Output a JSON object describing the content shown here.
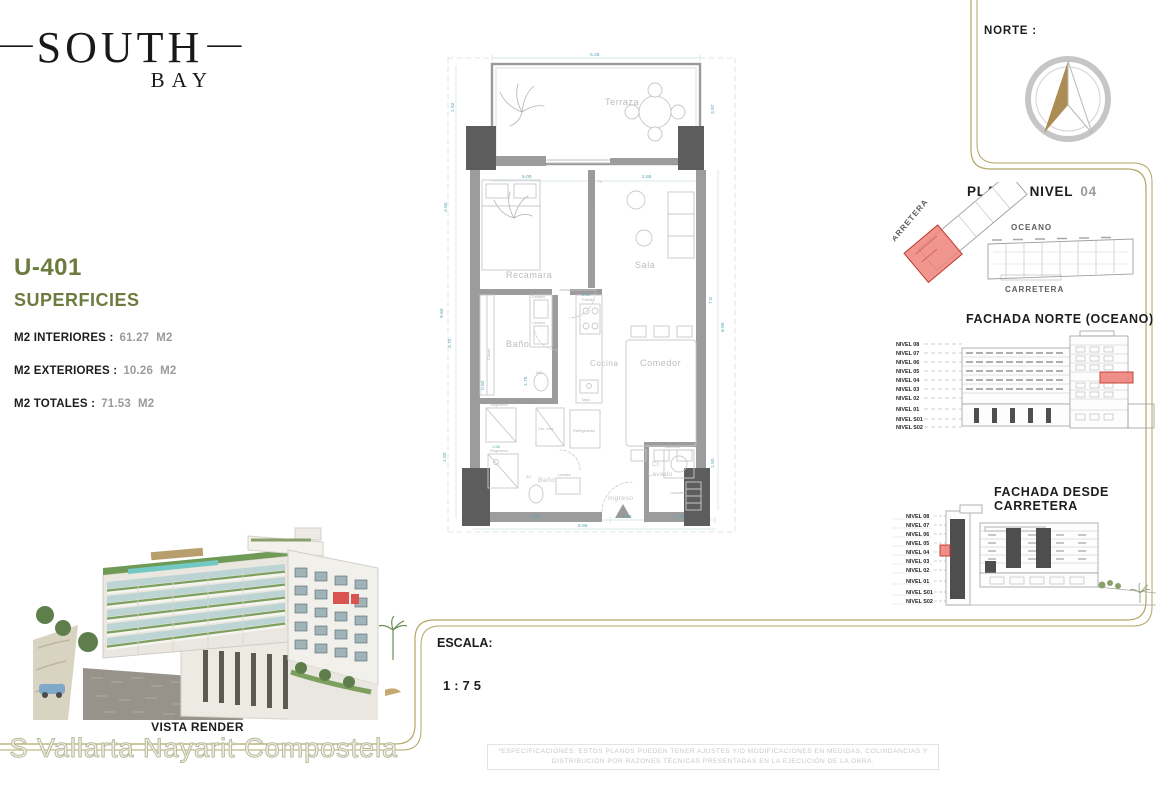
{
  "logo": {
    "dash": "—",
    "title": "SOUTH",
    "subtitle": "BAY"
  },
  "unit": {
    "id": "U-401",
    "section_title": "SUPERFICIES",
    "rows": [
      {
        "label": "M2 INTERIORES :",
        "value": "61.27",
        "m2": "M2"
      },
      {
        "label": "M2 EXTERIORES :",
        "value": "10.26",
        "m2": "M2"
      },
      {
        "label": "M2 TOTALES :",
        "value": "71.53",
        "m2": "M2"
      }
    ]
  },
  "norte": {
    "label": "NORTE :"
  },
  "planta": {
    "title": "PLANTA NIVEL",
    "number": "04",
    "top_label": "OCEANO",
    "bottom_label": "CARRETERA",
    "side_label": "CARRETERA"
  },
  "levels": [
    "NIVEL 08",
    "NIVEL 07",
    "NIVEL 06",
    "NIVEL 05",
    "NIVEL 04",
    "NIVEL 03",
    "NIVEL 02",
    "NIVEL 01",
    "NIVEL S01",
    "NIVEL S02"
  ],
  "fachada_norte": {
    "title": "FACHADA NORTE (OCEANO)"
  },
  "fachada_carretera": {
    "title": "FACHADA DESDE CARRETERA"
  },
  "floorplan": {
    "rooms": {
      "terraza": "Terraza",
      "recamara": "Recamara",
      "sala": "Sala",
      "bano": "Baño",
      "cocina": "Cocina",
      "comedor": "Comedor",
      "closet": "Closet",
      "cl_lavado_1": "Cl.",
      "cl_lavado_2": "Lavado",
      "ingreso": "Ingreso"
    },
    "fixtures": {
      "lavabo": "Lavabo",
      "wc": "WC",
      "parrilla": "Parrilla",
      "tarja": "Tarja",
      "refrigerador": "Refrigerador",
      "regadera": "Regadera",
      "lavadero": "Lavadero",
      "lav_sec": "Lav./Sec.",
      "cto_inst": "Cto. Inst.",
      "tv": "TV",
      "ac": "AC"
    },
    "dims": {
      "top": "5.28",
      "recamara_w": "5.00",
      "sala_w": "2.65",
      "l1": "1.52",
      "l2": "4.50",
      "l3": "9.60",
      "l4": "3.70",
      "l5": "1.50",
      "l6": "0.60",
      "d175": "1.75",
      "d158": "1.58",
      "parrilla_w": "0.90",
      "r1": "3.97",
      "r2": "7.6",
      "r3": "8.55",
      "r4": "1.50",
      "b1": "4.15",
      "b2": "1.20",
      "b3": "1.26",
      "b_total": "6.65"
    }
  },
  "vista_render": {
    "caption": "VISTA RENDER"
  },
  "escala": {
    "label": "ESCALA:",
    "value": "1:75"
  },
  "watermark": "l S Vallarta Nayarit Compostela",
  "disclaimer": "*ESPECIFICACIONES: ESTOS PLANOS PUEDEN TENER AJUSTES Y/O MODIFICACIONES EN MEDIDAS, COLINDANCIAS Y DISTRIBUCIÓN POR RAZONES TÉCNICAS PRESENTADAS EN LA EJECUCIÓN DE LA OBRA.",
  "colors": {
    "accent_olive": "#6d7b3f",
    "line_gold": "#b2a665",
    "highlight_red": "#e8746b",
    "value_gray": "#9b9b9b",
    "dim_teal": "#55a6b3",
    "compass_tan": "#ab8d54"
  }
}
